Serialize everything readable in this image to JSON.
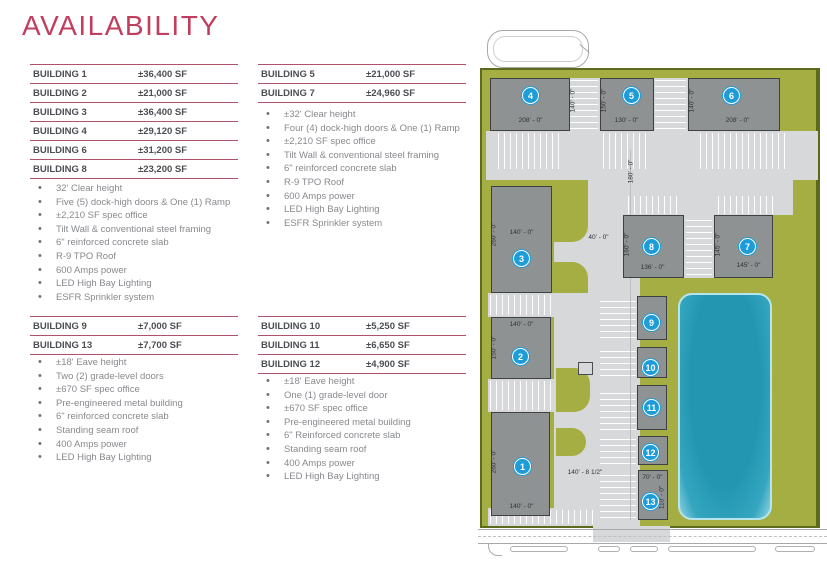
{
  "page": {
    "title": "AVAILABILITY"
  },
  "colors": {
    "accent": "#c13e5f",
    "table_line": "#b0516a",
    "site_green": "#a4ae42",
    "building_gray": "#8f9293",
    "pond_teal": "#2397b2",
    "badge_blue": "#1d9cd8"
  },
  "groups": {
    "g1": {
      "rows": [
        {
          "label": "BUILDING 1",
          "value": "±36,400 SF"
        },
        {
          "label": "BUILDING 2",
          "value": "±21,000 SF"
        },
        {
          "label": "BUILDING 3",
          "value": "±36,400 SF"
        },
        {
          "label": "BUILDING 4",
          "value": "±29,120 SF"
        },
        {
          "label": "BUILDING 6",
          "value": "±31,200 SF"
        },
        {
          "label": "BUILDING 8",
          "value": "±23,200 SF"
        }
      ],
      "bullets": [
        "32' Clear height",
        "Five (5) dock-high doors & One (1) Ramp",
        "±2,210 SF spec office",
        "Tilt Wall & conventional steel framing",
        "6\" reinforced concrete slab",
        "R-9 TPO Roof",
        "600 Amps power",
        "LED High Bay Lighting",
        "ESFR Sprinkler system"
      ]
    },
    "g2": {
      "rows": [
        {
          "label": "BUILDING 5",
          "value": "±21,000 SF"
        },
        {
          "label": "BUILDING 7",
          "value": "±24,960 SF"
        }
      ],
      "bullets": [
        "±32' Clear height",
        "Four (4) dock-high doors & One (1) Ramp",
        "±2,210 SF spec office",
        "Tilt Wall & conventional steel framing",
        "6\" reinforced concrete slab",
        "R-9 TPO Roof",
        "600 Amps power",
        "LED High Bay Lighting",
        "ESFR Sprinkler system"
      ]
    },
    "g3": {
      "rows": [
        {
          "label": "BUILDING 9",
          "value": "±7,000 SF"
        },
        {
          "label": "BUILDING 13",
          "value": "±7,700 SF"
        }
      ],
      "bullets": [
        "±18' Eave height",
        "Two (2) grade-level doors",
        "±670 SF spec office",
        "Pre-engineered metal building",
        "6\" reinforced concrete slab",
        "Standing seam roof",
        "400 Amps power",
        "LED High Bay Lighting"
      ]
    },
    "g4": {
      "rows": [
        {
          "label": "BUILDING 10",
          "value": "±5,250 SF"
        },
        {
          "label": "BUILDING 11",
          "value": "±6,650 SF"
        },
        {
          "label": "BUILDING 12",
          "value": "±4,900 SF"
        }
      ],
      "bullets": [
        "±18' Eave height",
        "One (1) grade-level door",
        "±670 SF spec office",
        "Pre-engineered metal building",
        "6\" Reinforced concrete slab",
        "Standing seam roof",
        "400 Amps power",
        "LED High Bay Lighting"
      ]
    }
  },
  "site_plan": {
    "buildings": {
      "b1": {
        "num": "1",
        "width": "140' - 0\"",
        "depth": "260' - 0\""
      },
      "b2": {
        "num": "2",
        "width": "140' - 0\"",
        "depth": "150' - 0\""
      },
      "b3": {
        "num": "3",
        "width": "140' - 0\"",
        "depth": "260' - 0\""
      },
      "b4": {
        "num": "4",
        "width": "208' - 0\"",
        "depth": "140' - 0\""
      },
      "b5": {
        "num": "5",
        "width": "130' - 0\"",
        "depth": "150' - 0\""
      },
      "b6": {
        "num": "6",
        "width": "208' - 0\"",
        "depth": "140' - 0\""
      },
      "b7": {
        "num": "7",
        "width": "145' - 0\"",
        "depth": "145' - 0\""
      },
      "b8": {
        "num": "8",
        "width": "136' - 0\"",
        "depth": "160' - 0\""
      },
      "b9": {
        "num": "9"
      },
      "b10": {
        "num": "10"
      },
      "b11": {
        "num": "11"
      },
      "b12": {
        "num": "12"
      },
      "b13": {
        "num": "13",
        "width": "70' - 0\"",
        "depth": "110' - 0\""
      }
    },
    "labels": {
      "drive_length": "180' - 0\"",
      "drive_width": "40' - 0\"",
      "frontage": "140' - 8 1/2\""
    }
  }
}
